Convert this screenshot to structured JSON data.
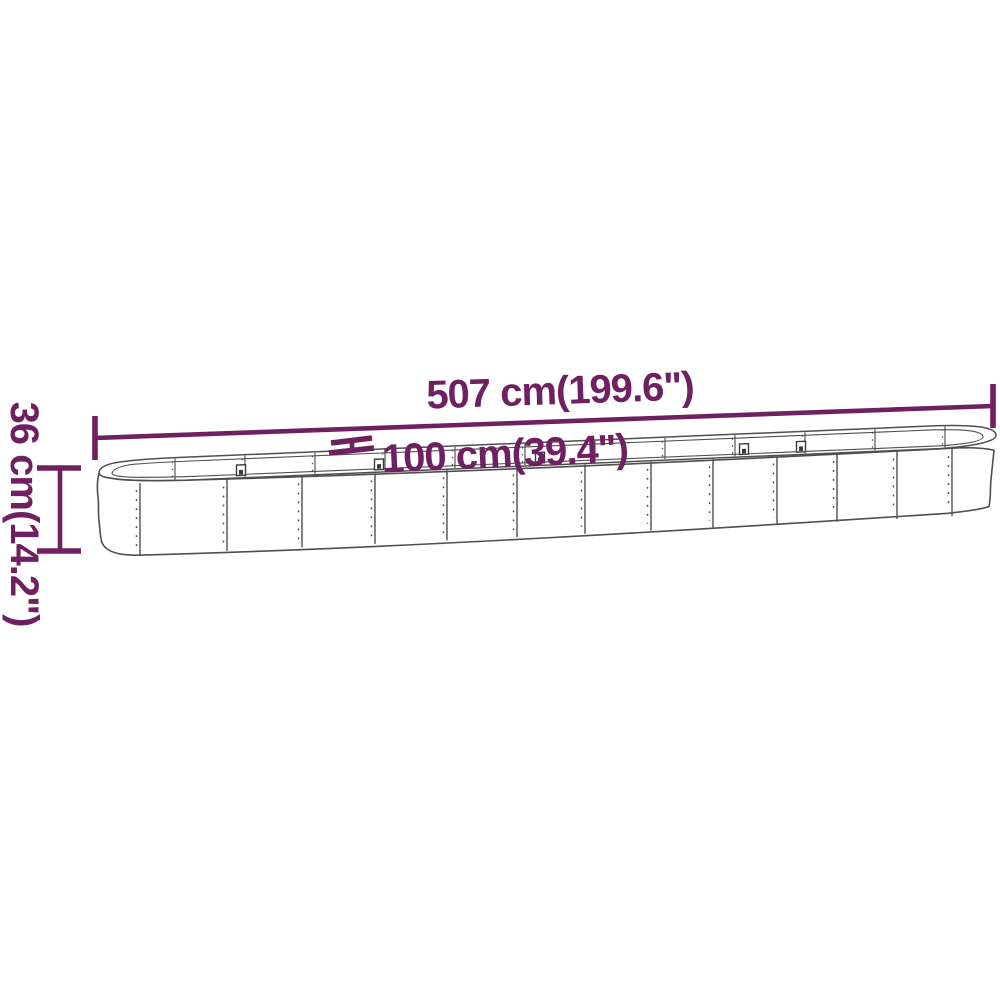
{
  "diagram": {
    "accent_color": "#6f2060",
    "outline_color": "#4f4f4f",
    "background_color": "#ffffff",
    "dimensions": {
      "length": {
        "label": "507 cm(199.6\")"
      },
      "width": {
        "label": "100 cm(39.4\")"
      },
      "height": {
        "label": "36 cm(14.2\")"
      }
    }
  }
}
